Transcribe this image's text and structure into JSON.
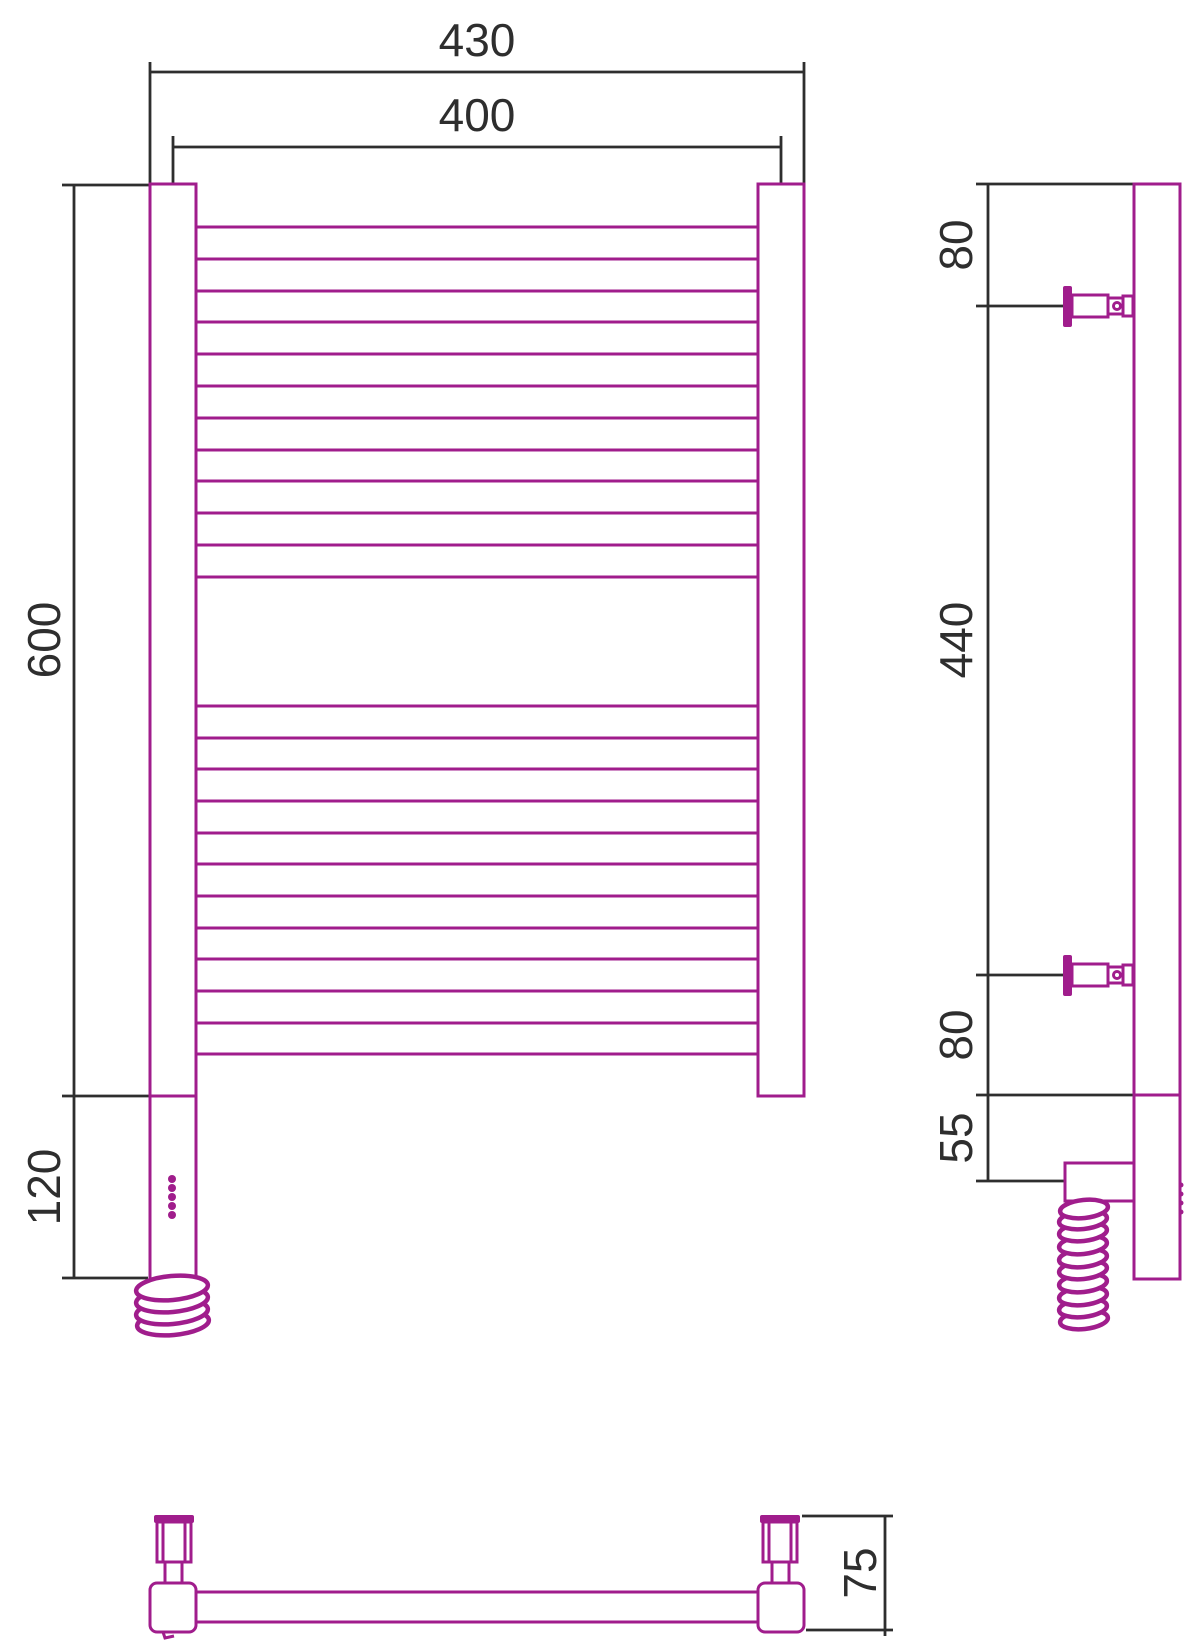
{
  "drawing": {
    "front": {
      "overall_width": "430",
      "center_width": "400",
      "height": "600",
      "heater_section": "120"
    },
    "side": {
      "top_offset": "80",
      "bracket_span": "440",
      "bottom_offset": "80",
      "heater_drop": "55"
    },
    "bottom": {
      "depth": "75"
    }
  },
  "colors": {
    "product_outline": "#A01D8C",
    "dimension_ink": "#2E2E2E",
    "background": "#FFFFFF"
  }
}
